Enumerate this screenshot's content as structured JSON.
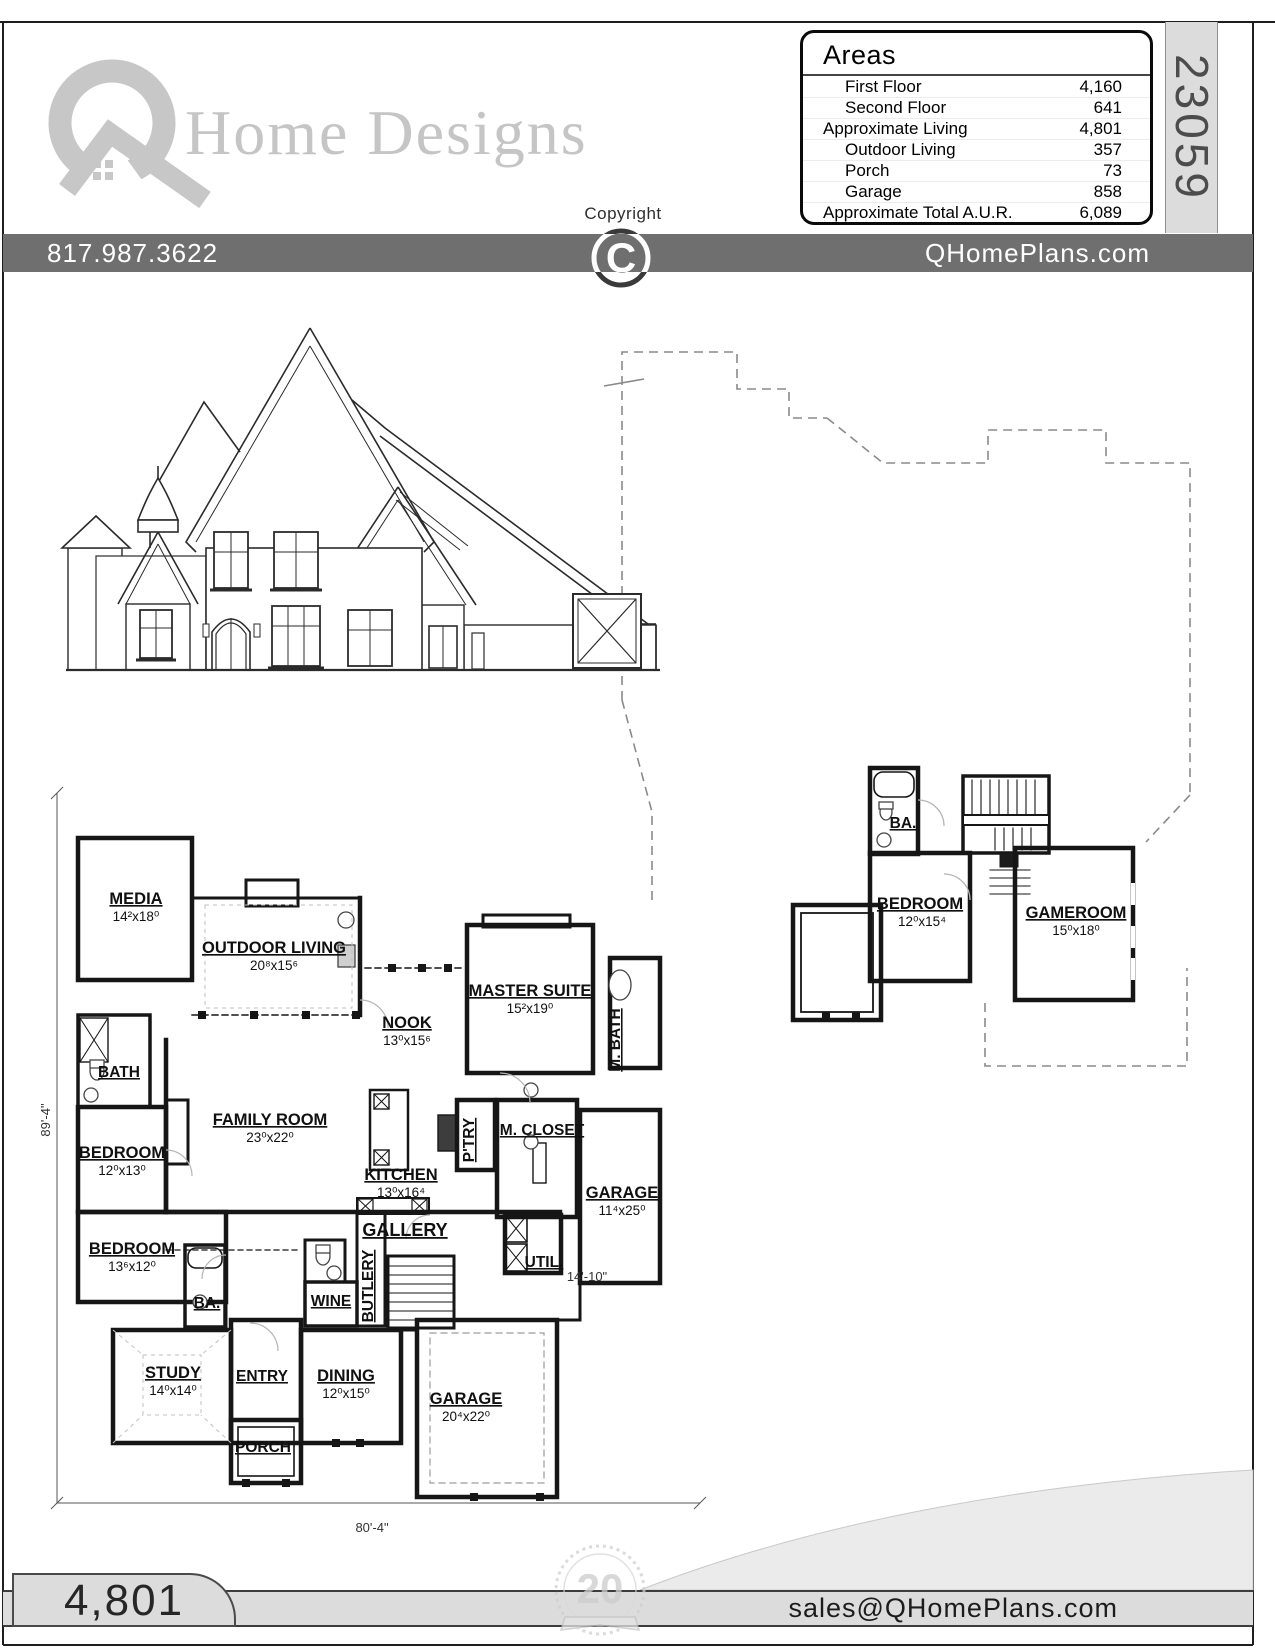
{
  "page": {
    "plan_number": "23059"
  },
  "brand": {
    "wordmark": "Home Designs",
    "logo_letter": "Q"
  },
  "copyright": {
    "label": "Copyright",
    "symbol": "C"
  },
  "areas_panel": {
    "title": "Areas",
    "rows": [
      {
        "label": "First Floor",
        "value": "4,160",
        "indent": true
      },
      {
        "label": "Second Floor",
        "value": "641",
        "indent": true
      },
      {
        "label": "Approximate Living",
        "value": "4,801",
        "indent": false
      },
      {
        "label": "Outdoor Living",
        "value": "357",
        "indent": true
      },
      {
        "label": "Porch",
        "value": "73",
        "indent": true
      },
      {
        "label": "Garage",
        "value": "858",
        "indent": true
      },
      {
        "label": "Approximate Total A.U.R.",
        "value": "6,089",
        "indent": false
      }
    ]
  },
  "contact_bar": {
    "phone": "817.987.3622",
    "website": "QHomePlans.com"
  },
  "first_floor": {
    "rooms": [
      {
        "label": "MEDIA",
        "size": "14²x18⁰"
      },
      {
        "label": "OUTDOOR LIVING",
        "size": "20⁸x15⁶"
      },
      {
        "label": "NOOK",
        "size": "13⁰x15⁶"
      },
      {
        "label": "MASTER SUITE",
        "size": "15²x19⁰"
      },
      {
        "label": "FAMILY ROOM",
        "size": "23⁰x22⁰"
      },
      {
        "label": "BEDROOM",
        "size": "12⁰x13⁰"
      },
      {
        "label": "KITCHEN",
        "size": "13⁰x16⁴"
      },
      {
        "label": "BEDROOM",
        "size": "13⁶x12⁰"
      },
      {
        "label": "GARAGE",
        "size": "11⁴x25⁰"
      },
      {
        "label": "STUDY",
        "size": "14⁰x14⁰"
      },
      {
        "label": "DINING",
        "size": "12⁰x15⁰"
      },
      {
        "label": "GARAGE",
        "size": "20⁴x22⁰"
      }
    ],
    "annotations": [
      {
        "label": "BATH"
      },
      {
        "label": "M. BATH"
      },
      {
        "label": "P'TRY"
      },
      {
        "label": "M. CLOSET"
      },
      {
        "label": "GALLERY"
      },
      {
        "label": "BA."
      },
      {
        "label": "WINE"
      },
      {
        "label": "BUTLERY"
      },
      {
        "label": "UTIL."
      },
      {
        "label": "ENTRY"
      },
      {
        "label": "PORCH"
      }
    ],
    "dimensions": {
      "side": "89'-4\"",
      "front": "80'-4\"",
      "garage": "14'-10\""
    }
  },
  "second_floor": {
    "rooms": [
      {
        "label": "BEDROOM",
        "size": "12⁰x15⁴"
      },
      {
        "label": "GAMEROOM",
        "size": "15⁰x18⁰"
      }
    ],
    "annotations": [
      {
        "label": "BA."
      }
    ]
  },
  "footer": {
    "living_area": "4,801",
    "email": "sales@QHomePlans.com",
    "badge_number": "20"
  }
}
